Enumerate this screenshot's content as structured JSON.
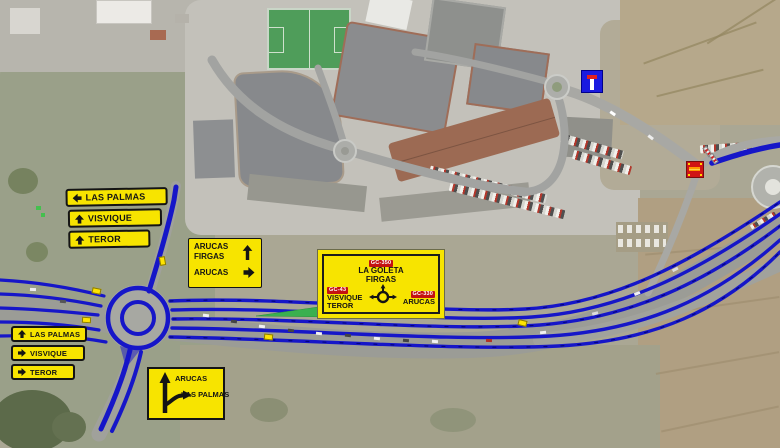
{
  "signs": {
    "nw": {
      "panels": [
        {
          "arrow": "left",
          "label": "LAS PALMAS"
        },
        {
          "arrow": "up",
          "label": "VISVIQUE"
        },
        {
          "arrow": "up",
          "label": "TEROR"
        }
      ]
    },
    "approach": {
      "line1": "ARUCAS",
      "line2": "FIRGAS",
      "line3": "ARUCAS"
    },
    "goleta": {
      "badge_top": "GC-350",
      "dest_top1": "LA GOLETA",
      "dest_top2": "FIRGAS",
      "badge_left": "GC-43",
      "dest_left1": "VISVIQUE",
      "dest_left2": "TEROR",
      "badge_right": "GC-330",
      "dest_right": "ARUCAS"
    },
    "west": {
      "panels": [
        {
          "arrow": "up",
          "label": "LAS PALMAS"
        },
        {
          "arrow": "right",
          "label": "VISVIQUE"
        },
        {
          "arrow": "right",
          "label": "TEROR"
        }
      ]
    },
    "fork": {
      "straight": "ARUCAS",
      "branch": "LAS PALMAS"
    }
  },
  "icons": {
    "dead_end": "dead-end-sign",
    "road_closed": "road-closed-sign",
    "roundabout_glyph": "roundabout-icon",
    "arrows": [
      "up-arrow-icon",
      "left-arrow-icon",
      "right-arrow-icon",
      "fork-arrow-icon"
    ]
  },
  "colors": {
    "overlay_blue": "#1616c8",
    "sign_yellow": "#f7e400",
    "badge_red": "#c41111",
    "dead_end_blue": "#1a1ae0",
    "road_closed_red": "#d01414",
    "lane_green": "#3ab04f"
  }
}
